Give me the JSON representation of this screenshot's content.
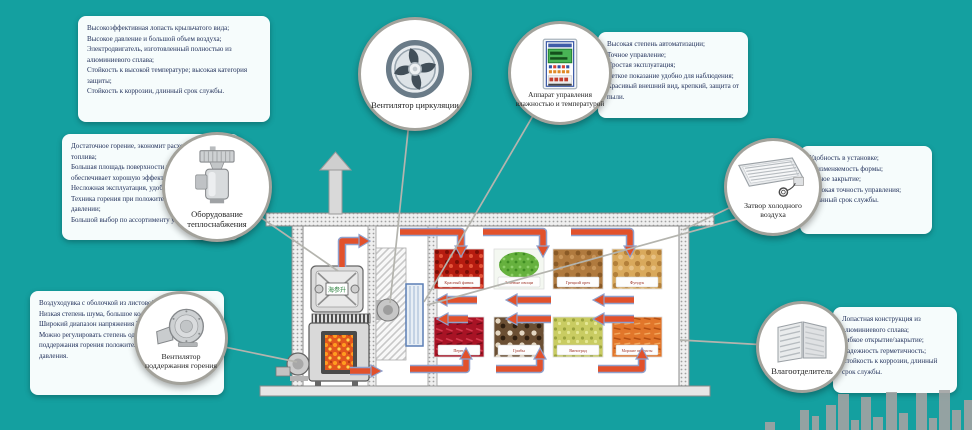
{
  "palette": {
    "background": "#14a0a0",
    "note_background": "#f6fcfc",
    "note_text": "#21305a",
    "arrow_red": "#e2512b",
    "arrow_outline": "#8fa0cc",
    "connector_line": "#b4b4ae",
    "skyline_bar": "#a2a2a2"
  },
  "callouts": {
    "circulation_fan": {
      "label": "Вентилятор циркуляции",
      "note": "Высокоэффективная лопасть крыльчатого вида;\nВысокое давление и большой объем воздуха;\nЭлектродвигатель, изготовленный полностью из алюминиевого сплава;\nСтойкость к высокой температуре; высокая категория защиты;\nСтойкость к коррозии, длинный срок службы."
    },
    "control_unit": {
      "label": "Аппарат управления влажностью и температурой",
      "note": "Высокая степень автоматизации;\nТочное управление;\nПростая эксплуатация;\nЧеткое показание удобно для наблюдения;\nКрасивый внешний вид, крепкий, защита от пыли."
    },
    "heating_equipment": {
      "label": "Оборудование теплоснабжения",
      "note": "Достаточное горение, экономит расходование топлива;\nБольшая площадь поверхности теплообмена обеспечивает хорошую эффективность теплообмена;\nНесложная эксплуатация, удобно для очистки;\nТехника горения при положительном/отрицательном давлении;\nБольшой выбор по ассортименту угля"
    },
    "combustion_fan": {
      "label": "Вентилятор поддержания горения",
      "note": "Воздуходувка с оболочкой из листовой стали;\nНизкая степень шума, большое количество дутья;\nШирокий диапазон напряжения 220В+/-20%В;\nМожно регулировать степень одновременно вентилятора поддержания горения положительного и отрицательного давления."
    },
    "cold_air_valve": {
      "label": "Затвор холодного воздуха",
      "note": "Удобность в установке;\nНеизменяемость формы;\nТесное закрытие;\nВысокая точность управления;\nДлинный срок службы."
    },
    "moisture_separator": {
      "label": "Влагоотделитель",
      "note": "Лопастная конструкция из алюминиевого сплава;\nГибкое открытие/закрытие;\nНадежность герметичность;\nСтойкость к коррозии, длинный срок службы."
    }
  },
  "diagram": {
    "furnace_brand": "海参升",
    "products": [
      "Красный финик",
      "Зеленые овощи",
      "Грецкий орех",
      "Фундук",
      "Перец",
      "Грибы",
      "Виноград",
      "Морские продукты"
    ]
  }
}
